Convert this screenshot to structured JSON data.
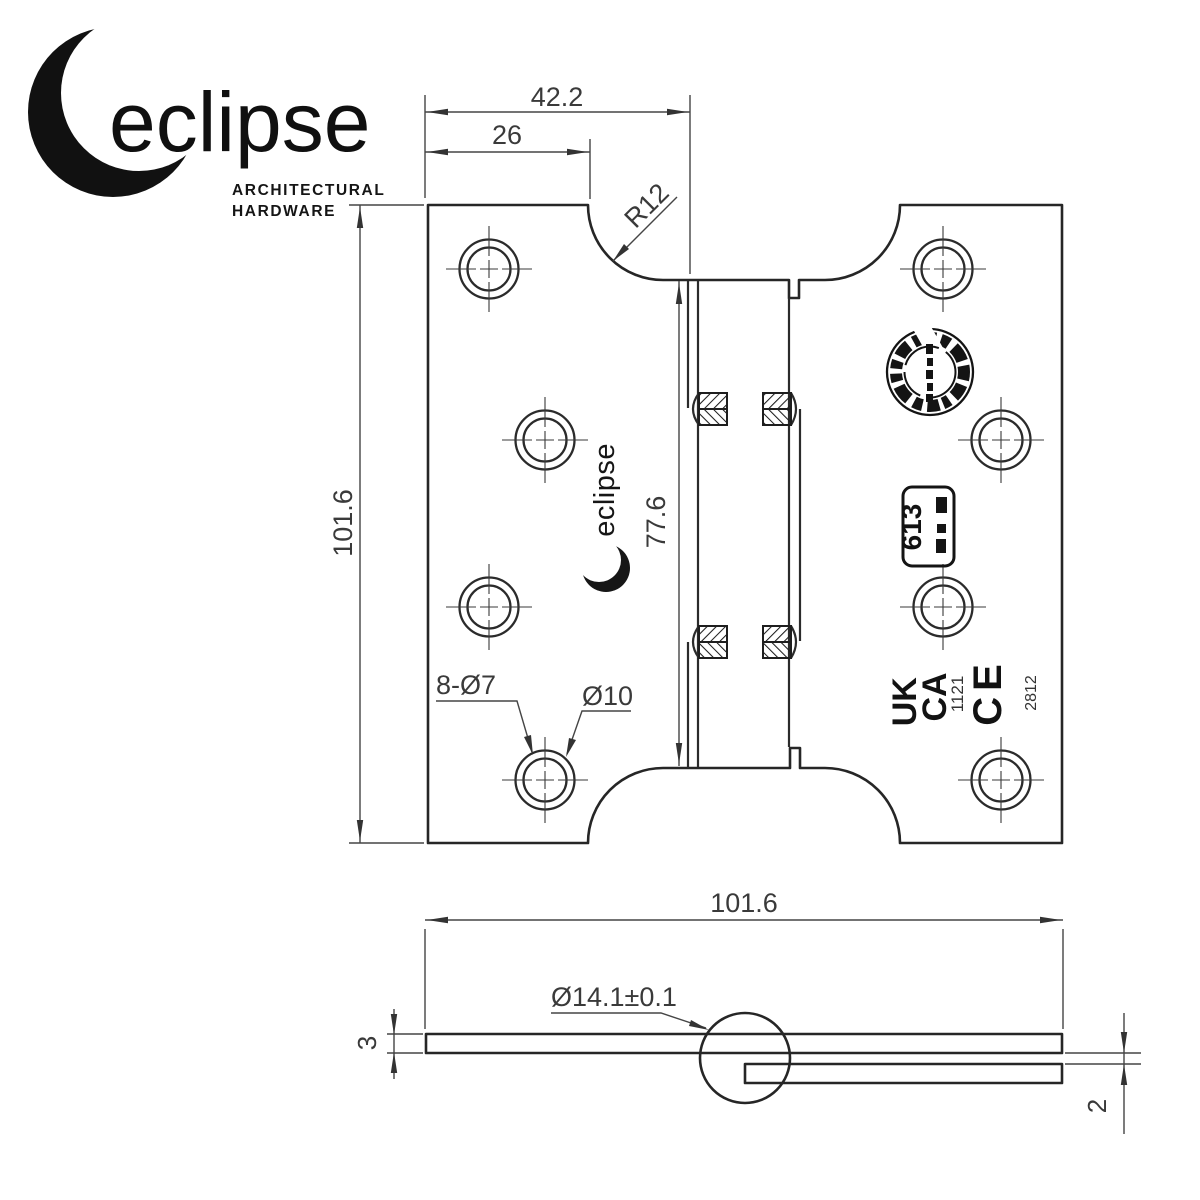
{
  "brand": {
    "logo_text": "eclipse",
    "tagline_line1": "ARCHITECTURAL",
    "tagline_line2": "HARDWARE"
  },
  "colors": {
    "line": "#262626",
    "dim": "#454545",
    "ink": "#121212",
    "background": "#ffffff"
  },
  "main_view": {
    "dim_overall_leaf_width": "42.2",
    "dim_hole_offset": "26",
    "corner_radius": "R12",
    "dim_height": "101.6",
    "dim_knuckle_length": "77.6",
    "hole_callout": "8-Ø7",
    "countersink_callout": "Ø10",
    "grade_stamp": "613",
    "ukca_line1": "UK",
    "ukca_line2": "CA",
    "ukca_body_number": "1121",
    "ce_mark": "CE",
    "ce_body_number": "2812",
    "leaf_logo_stamp": "eclipse"
  },
  "side_view": {
    "dim_open_width": "101.6",
    "knuckle_diameter": "Ø14.1±0.1",
    "dim_leaf_thickness": "3",
    "dim_leaf_gap": "2"
  }
}
